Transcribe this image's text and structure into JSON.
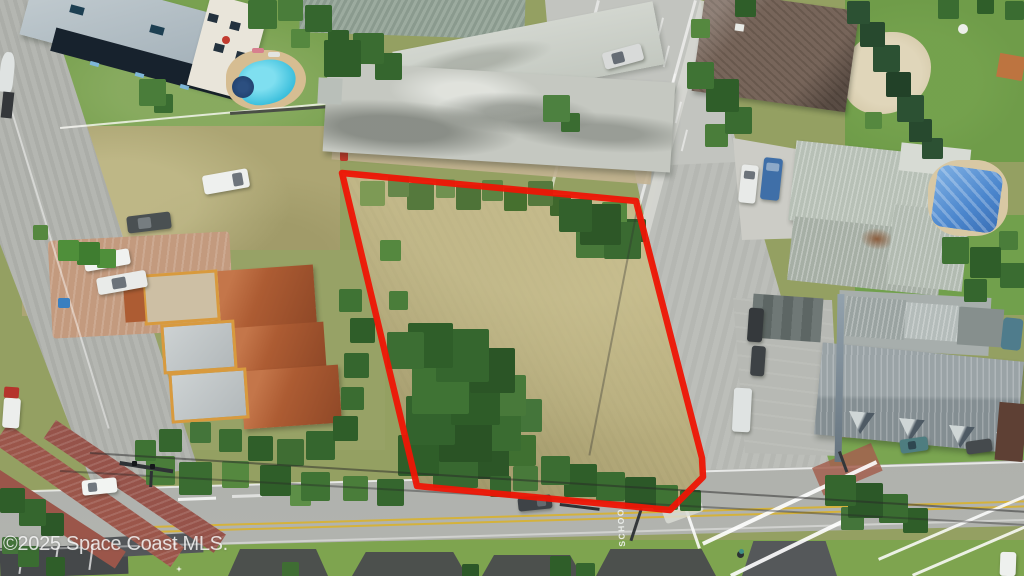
{
  "image": {
    "type": "aerial-drone-photo",
    "subject": "Aerial view of a vacant land parcel outlined in red between residential and commercial properties",
    "width_px": 1024,
    "height_px": 576
  },
  "watermark": {
    "text": "©2025 Space Coast MLS."
  },
  "road_markings": {
    "school": "SCHOOL"
  },
  "parcel": {
    "label": "vacant-lot-outlined-in-red",
    "outline_color": "#ee1505",
    "points": "342,173 636,201 702,458 703,477 670,510 417,486"
  },
  "colors": {
    "parcel_outline": "#ee1505",
    "dry_grass": "#b2a677",
    "green_lawn": "#79a150",
    "road_asphalt": "#b6b8b3",
    "concrete": "#cbccc6",
    "brick_paving": "#9b564a",
    "terracotta_roof": "#ad5c33",
    "weathered_gray_roof": "#c5c8c1",
    "metal_roof": "#b3bcb2",
    "brown_shingle_roof": "#77655a",
    "pool_water": "#3ec0dd",
    "pool_tarp": "#4b86cd",
    "center_line_yellow": "#d4b23c"
  },
  "scene": {
    "landmarks": [
      "condominium with swimming pool (top left)",
      "commercial buildings with parking lot (top center)",
      "brown-roof house with sand yard (top right)",
      "metal-roof house with covered pool (right)",
      "gray gabled building with dormers and parking (lower right)",
      "terracotta-roof townhomes (left)",
      "open grass lot with parked cars (left)",
      "main road with SCHOOL pavement marking (bottom)",
      "side road (left edge)",
      "side road (right, along parcel)",
      "brick-paved crosswalk intersection (bottom left)",
      "striped crosswalk intersection (bottom right)",
      "cyclist crossing road (bottom right)"
    ]
  }
}
